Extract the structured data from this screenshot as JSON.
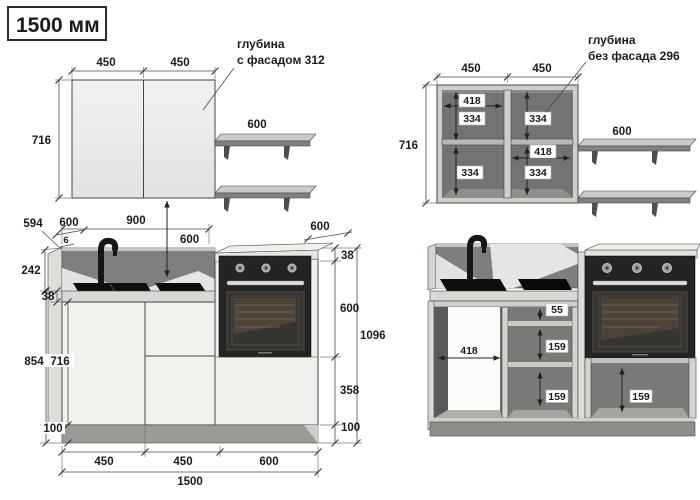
{
  "title": "1500 мм",
  "colors": {
    "facade": "#efeeec",
    "carcass_interior": "#747372",
    "oven_front": "#242423",
    "countertop": "#d9d8d4",
    "backsplash": "#7e7e7c",
    "plinth": "#95948f",
    "drawing_line": "#454545"
  },
  "views": {
    "upper_front": {
      "note_line1": "глубина",
      "note_line2": "с фасадом 312",
      "dim_door_left": "450",
      "dim_door_right": "450",
      "dim_height": "716",
      "dim_shelf_depth": "600"
    },
    "upper_carcass": {
      "note_line1": "глубина",
      "note_line2": "без фасада 296",
      "dim_door_left": "450",
      "dim_door_right": "450",
      "dim_height": "716",
      "dim_shelf_depth": "600",
      "dim_inner_width_left": "418",
      "dim_inner_width_right": "418",
      "dim_half_left_top": "334",
      "dim_half_left_bottom": "334",
      "dim_half_right_top": "334",
      "dim_half_right_bottom": "334"
    },
    "base_front": {
      "dim_side_panel_depth": "594",
      "dim_counter_depth": "600",
      "dim_overhang": "6",
      "dim_span_left": "900",
      "dim_wall_gap": "600",
      "dim_splash_height": "242",
      "dim_counter_thickness": "38",
      "dim_height_to_counter": "854",
      "dim_box_height": "716",
      "dim_plinth_left": "100",
      "dim_tall_depth": "600",
      "dim_tall_counter": "38",
      "dim_oven_height": "600",
      "dim_tall_height": "1096",
      "dim_drawer_height": "358",
      "dim_plinth_right": "100",
      "dim_width_1": "450",
      "dim_width_2": "450",
      "dim_width_3": "600",
      "dim_width_total": "1500"
    },
    "base_carcass": {
      "dim_opening_width": "418",
      "dim_top_drawer": "55",
      "dim_mid_drawer": "159",
      "dim_bottom_drawer": "159",
      "dim_oven_drawer": "159"
    }
  }
}
